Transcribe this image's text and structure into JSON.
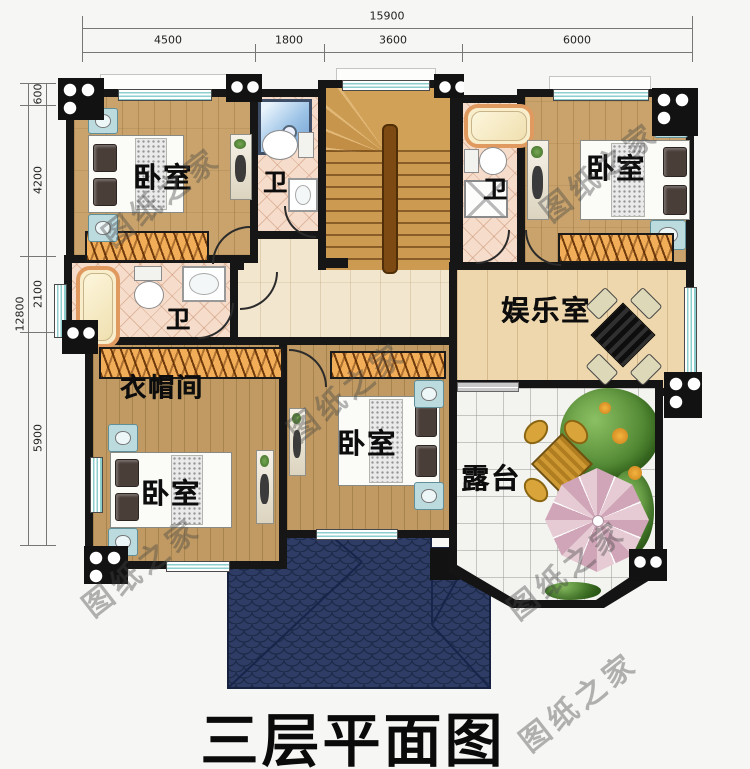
{
  "title": "三层平面图",
  "watermark_text": "图纸之家",
  "dimensions": {
    "top_total": "15900",
    "top_segments": [
      "4500",
      "1800",
      "3600",
      "6000"
    ],
    "left_total": "12800",
    "left_segments": [
      "600",
      "4200",
      "2100",
      "5900"
    ]
  },
  "rooms": {
    "bedroom_top_left": "卧室",
    "bath_top": "卫",
    "bath_right": "卫",
    "bedroom_top_right": "卧室",
    "bath_left": "卫",
    "cloakroom": "衣帽间",
    "bedroom_bottom_left": "卧室",
    "bedroom_bottom_middle": "卧室",
    "entertainment_room": "娱乐室",
    "terrace": "露台"
  },
  "colors": {
    "wall": "#161616",
    "wood": "#c9a36b",
    "wood_dark": "#c09a62",
    "hallway": "#f2e6cf",
    "ent_wood": "#eed7ad",
    "tile": "#f6dccb",
    "terrace_tile": "#f3f3f0",
    "window": "#8ccfce",
    "wardrobe": "#f2ad58",
    "stairs": "#cd9a52",
    "roof": "#2e3c66",
    "title": "#0a0a0a"
  }
}
